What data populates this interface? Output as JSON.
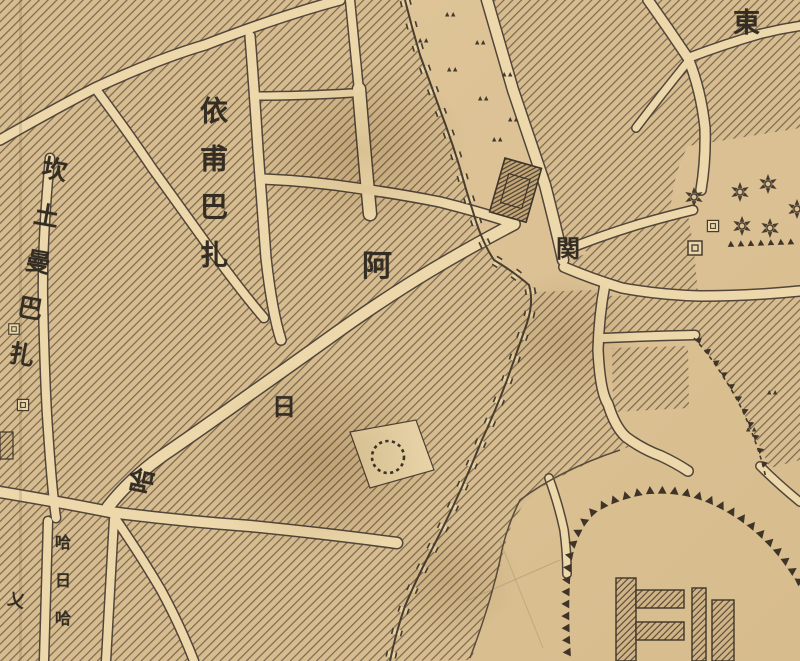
{
  "map": {
    "title": "historical-bazaar-city-map",
    "region_labels": {
      "yipu_bazaar": "依甫巴扎",
      "kantuman_bazaar": "坎土曼巴扎",
      "street_char_a": "阿",
      "street_char_ri": "日",
      "street_char_ha": "哈",
      "gate": "関",
      "east": "東",
      "small_street": "哈日哈",
      "figure_mark": "乂"
    },
    "symbols": {
      "star": "six-pointed-star-marker",
      "mosque_square": "nested-square-marker",
      "triangle_fringe": "triangle-hachure",
      "grass": "grass-tuft-marker",
      "wall": "crenellated-city-wall",
      "dotted_circle": "dotted-circle-enclosure",
      "gate_tower": "gate-tower-block"
    },
    "colors": {
      "paper": "#ddc397",
      "street": "#ecd8aa",
      "block": "#d6bc8e",
      "ink": "#463a2d",
      "hatch": "#77654e"
    }
  }
}
